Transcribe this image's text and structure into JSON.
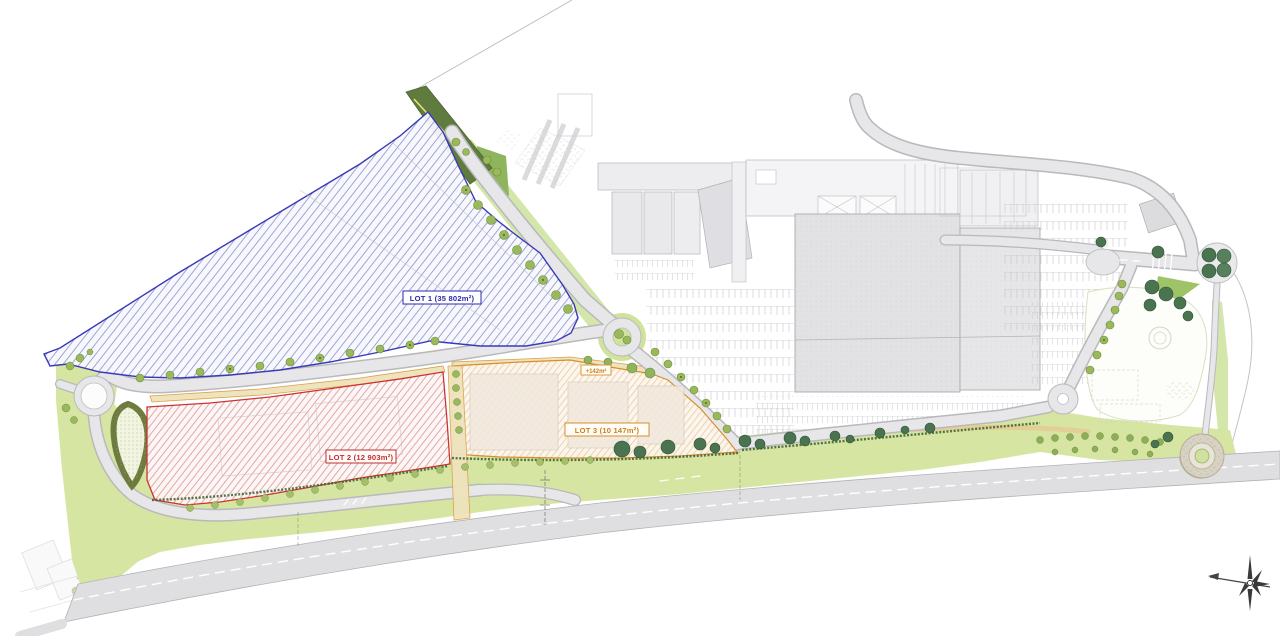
{
  "plan": {
    "title": "Commercial zone site development plan",
    "lot1": {
      "label": "LOT 1 (35 802m²)",
      "color": "#2a2ab0",
      "hatch": "blue-diagonal"
    },
    "lot2": {
      "label": "LOT 2 (12 903m²)",
      "color": "#c03030",
      "hatch": "red-diagonal"
    },
    "lot3": {
      "label": "LOT 3 (10 147m²)",
      "color": "#d78f2e",
      "hatch": "orange-diagonal"
    },
    "annex": {
      "label": "+142m²",
      "color": "#d78f2e"
    }
  },
  "features": {
    "roundabout_west": "roundabout",
    "roundabout_center": "roundabout-with-trees",
    "roundabout_east": "roundabout",
    "tree_circle": "planted-circle",
    "spiral_mound": "gravel-spiral",
    "basin": "planted-retention-basin",
    "hedge": "tree-hedge-strip",
    "main_road": "boulevard",
    "compass": "north-arrow"
  },
  "colors": {
    "road": "#e7e7e9",
    "road_edge": "#b3b3b7",
    "green_light": "#d6e6a2",
    "green_mid": "#9fc468",
    "green_dark": "#4a7350",
    "hedge_dark": "#5f7c3e",
    "tan_path": "#efe3bd",
    "tan_edge": "#d9a24a",
    "building": "#e4e4e7"
  }
}
